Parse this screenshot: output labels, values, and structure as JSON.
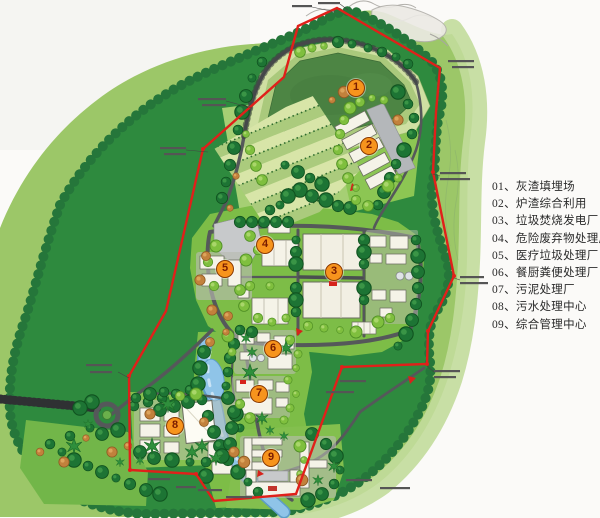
{
  "legend": {
    "items": [
      "01、灰渣填埋场",
      "02、炉渣综合利用",
      "03、垃圾焚烧发电厂",
      "04、危险废弃物处理厂",
      "05、医疗垃圾处理厂",
      "06、餐厨粪便处理厂",
      "07、污泥处理厂",
      "08、污水处理中心",
      "09、综合管理中心"
    ]
  },
  "markers": [
    "1",
    "2",
    "3",
    "4",
    "5",
    "6",
    "7",
    "8",
    "9"
  ],
  "colors": {
    "boundary_red": "#e0201a",
    "marker_orange": "#f7941d",
    "forest_green": "#2e8a3e",
    "meadow_green": "#9cc768",
    "water_blue": "#8fc4e8"
  }
}
